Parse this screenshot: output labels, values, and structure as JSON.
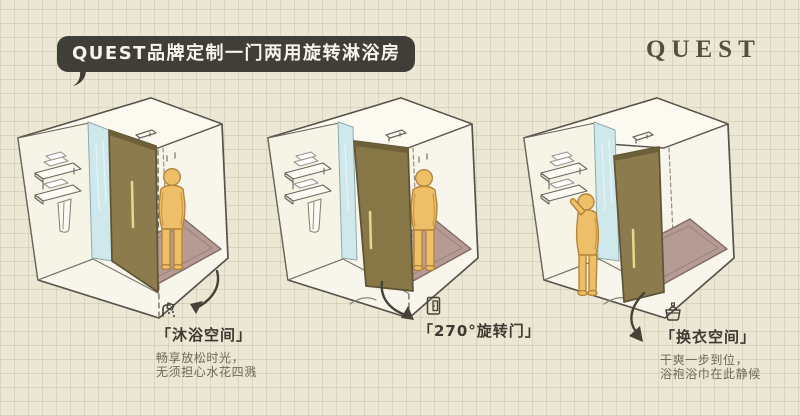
{
  "badge": {
    "label": "QUEST品牌定制一门两用旋转淋浴房"
  },
  "logo": {
    "label": "QUEST"
  },
  "panels": [
    {
      "icon": "shower-icon",
      "title": "「沐浴空间」",
      "sub1": "畅享放松时光，",
      "sub2": "无须担心水花四溅"
    },
    {
      "icon": "door-icon",
      "title": "「270°旋转门」",
      "sub1": "",
      "sub2": ""
    },
    {
      "icon": "basket-icon",
      "title": "「换衣空间」",
      "sub1": "干爽一步到位，",
      "sub2": "浴袍浴巾在此静候"
    }
  ],
  "colors": {
    "paper": "#ebe7d4",
    "grid_line": "#d8d3bc",
    "badge_bg": "#403e38",
    "badge_text": "#f6f4ec",
    "logo_text": "#55503c",
    "sketch_line": "#57524a",
    "door": "#8c7b4d",
    "door_edge": "#6d6039",
    "glass": "#cfe8ec",
    "figure": "#ecbf68",
    "figure_outline": "#b5853a",
    "shower_mat": "#b69b94",
    "title_text": "#3e3a31",
    "sub_text": "#6e6859"
  }
}
